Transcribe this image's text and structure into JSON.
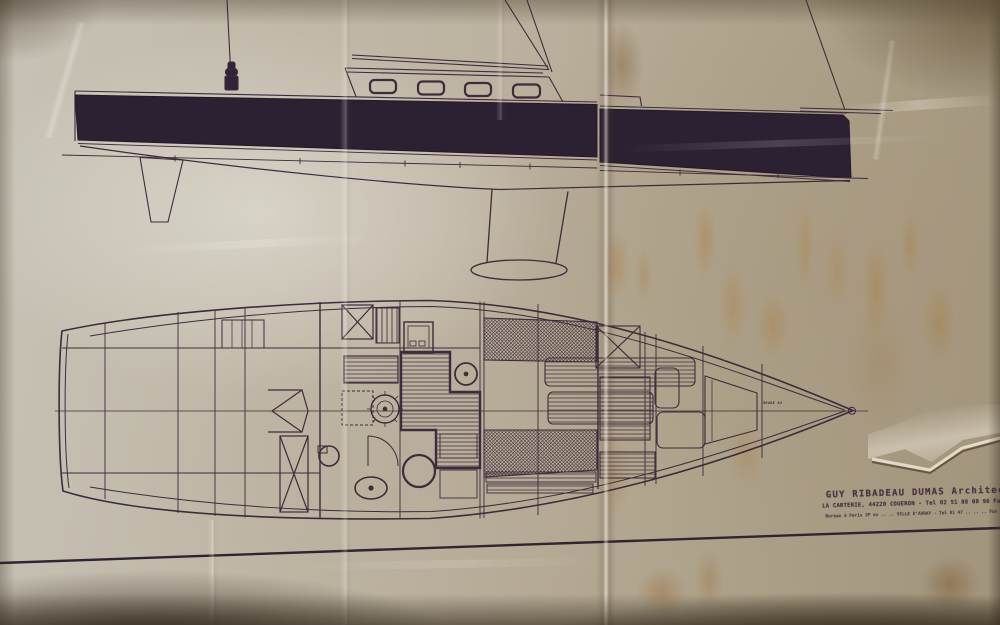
{
  "document": {
    "type": "photo-of-sailing-yacht-drawing",
    "views": {
      "top": "sailboat profile (side elevation) with dark hull topsides, coachroof with four portlights, fin keel with bulb, spade rudder, rigging lines",
      "bottom": "interior accommodation plan (deck plan) with galley, saloon, berths and forepeak"
    }
  },
  "title_block": {
    "line1": "GUY RIBADEAU DUMAS  Architecte No",
    "line2": "LA CARTERIE, 44220 COUERON - Tel 02 51 08 00 96 Fax 02 40 85",
    "line3": "Bureau à Paris 3P av .. .. VILLE D'AVRAY - Tel 01 47 .. .. .. Fax 01 47 .."
  },
  "plan_annotations": {
    "bow_label": "GRADE AV"
  },
  "colors": {
    "paper": "#bdb3a0",
    "ink": "#3e2b3b",
    "hull_fill": "#2c2033",
    "stain": "#a9824e",
    "border_line": "#2f2430"
  }
}
